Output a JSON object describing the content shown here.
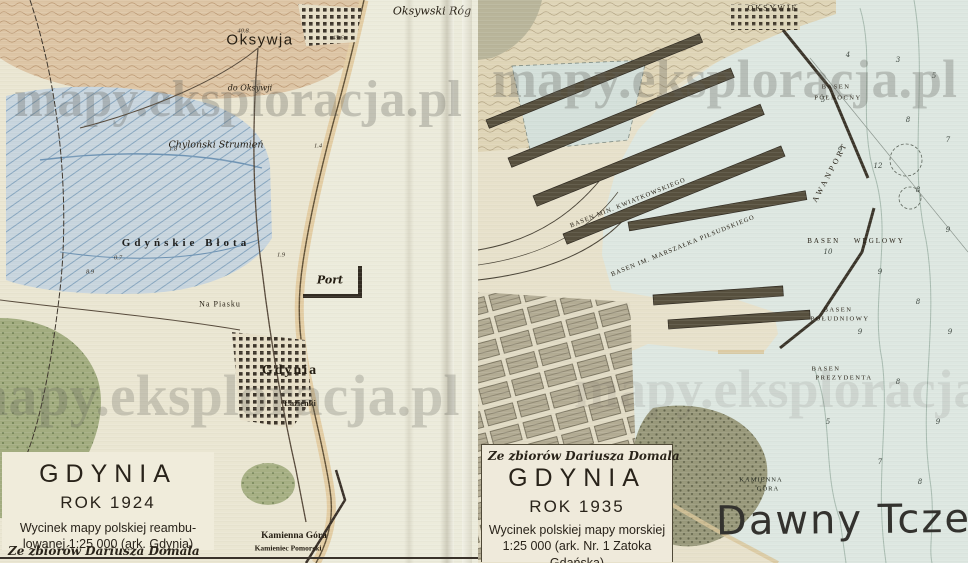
{
  "watermark": {
    "text": "mapy.eksploracja.pl"
  },
  "left_sheet": {
    "credit": "Ze zbiorów Dariusza Domala",
    "legend": {
      "title": "GDYNIA",
      "year": "ROK 1924",
      "desc_line1": "Wycinek mapy polskiej reambu-",
      "desc_line2": "lowanej 1:25 000 (ark. Gdynia)"
    },
    "labels": {
      "oksywja": "Oksywja",
      "oksywski_rog": "Oksywski Róg",
      "do_oksywji": "do Oksywji",
      "chylonski_strumien": "Chyloński Strumień",
      "gdynskie_blota": "Gdyńskie Błota",
      "port": "Port",
      "na_piasku": "Na Piasku",
      "gdynia": "Gdynia",
      "lazienki": "Łazienki",
      "kamienna_gora": "Kamienna Góra",
      "kamieniec_pomorski": "Kamieniec Pomorski"
    },
    "spot_heights": [
      "40.8",
      "45.6",
      "1.4",
      "1.8",
      "0.7",
      "8.9",
      "1.9"
    ]
  },
  "right_sheet": {
    "credit": "Ze zbiorów Dariusza Domala",
    "legend": {
      "title": "GDYNIA",
      "year": "ROK 1935",
      "desc_line1": "Wycinek polskiej mapy morskiej",
      "desc_line2": "1:25 000 (ark. Nr. 1 Zatoka",
      "desc_line3": "Gdańska)"
    },
    "labels": {
      "oksywie": "OKSYWIE",
      "basen_polnocny_line1": "BASEN",
      "basen_polnocny_line2": "PÓŁNOCNY",
      "awanport": "AWANPORT",
      "basen_kwiatkowskiego": "BASEN MIN. KWIATKOWSKIEGO",
      "basen_pilsudskiego": "BASEN IM. MARSZAŁKA PIŁSUDSKIEGO",
      "basen_weglowy": "BASEN WĘGLOWY",
      "basen_poludniowy_line1": "BASEN",
      "basen_poludniowy_line2": "POŁUDNIOWY",
      "basen_prezydenta_line1": "BASEN",
      "basen_prezydenta_line2": "PREZYDENTA",
      "kamienna_gora_line1": "KAMIENNA",
      "kamienna_gora_line2": "GÓRA"
    },
    "soundings": [
      "4",
      "3",
      "5",
      "5",
      "8",
      "7",
      "9",
      "12",
      "8",
      "9",
      "10",
      "9",
      "8",
      "9",
      "9",
      "8",
      "9",
      "5",
      "7",
      "8"
    ],
    "overlay_text": "Dawny Tczew"
  }
}
